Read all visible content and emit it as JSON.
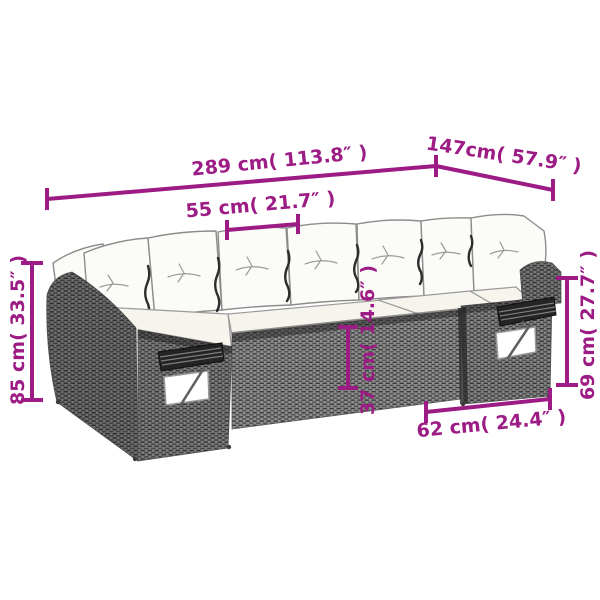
{
  "accent_color": "#9C1B84",
  "dimensions": {
    "overall_length": {
      "label": "289 cm( 113.8″ )"
    },
    "side_depth": {
      "label": "147cm( 57.9″ )"
    },
    "seat_width": {
      "label": "55 cm( 21.7″ )"
    },
    "back_height": {
      "label": "85 cm( 33.5″ )"
    },
    "seat_height": {
      "label": "37 cm( 14.6″ )"
    },
    "arm_height": {
      "label": "69 cm( 27.7″ )"
    },
    "module_depth": {
      "label": "62 cm( 24.4″ )"
    }
  }
}
